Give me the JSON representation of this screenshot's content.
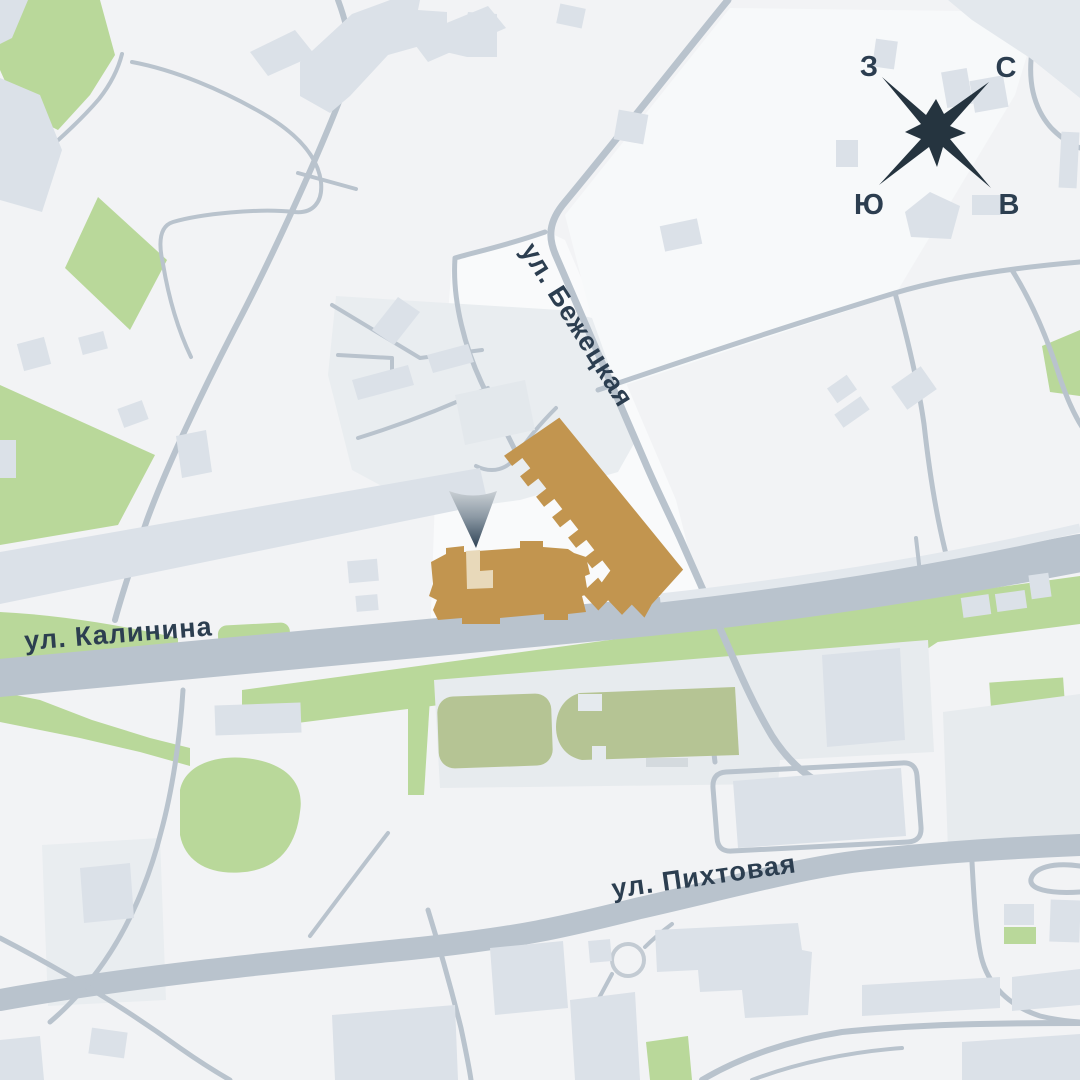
{
  "title": "Схема расположения жилого комплекса на карте района",
  "streets": [
    {
      "name": "ул. Бежецкая"
    },
    {
      "name": "ул. Калинина"
    },
    {
      "name": "ул. Пихтовая"
    }
  ],
  "compass": {
    "west": "З",
    "north": "С",
    "south": "Ю",
    "east": "В"
  },
  "marker": {
    "type": "location-pin",
    "gradient_top": "#c9cfd4",
    "gradient_bottom": "#2e4255"
  },
  "colors": {
    "background": "#f2f3f5",
    "city_block": "#f8fafb",
    "building": "#dbe1e8",
    "platform": "#e7ebee",
    "road": "#b9c3cd",
    "green_area": "#b9d89a",
    "sports_field": "#b5c494",
    "highlight_building": "#c2954f",
    "highlight_section": "#e8d9ba",
    "label_text": "#2c3e50",
    "compass_star": "#25343f"
  }
}
